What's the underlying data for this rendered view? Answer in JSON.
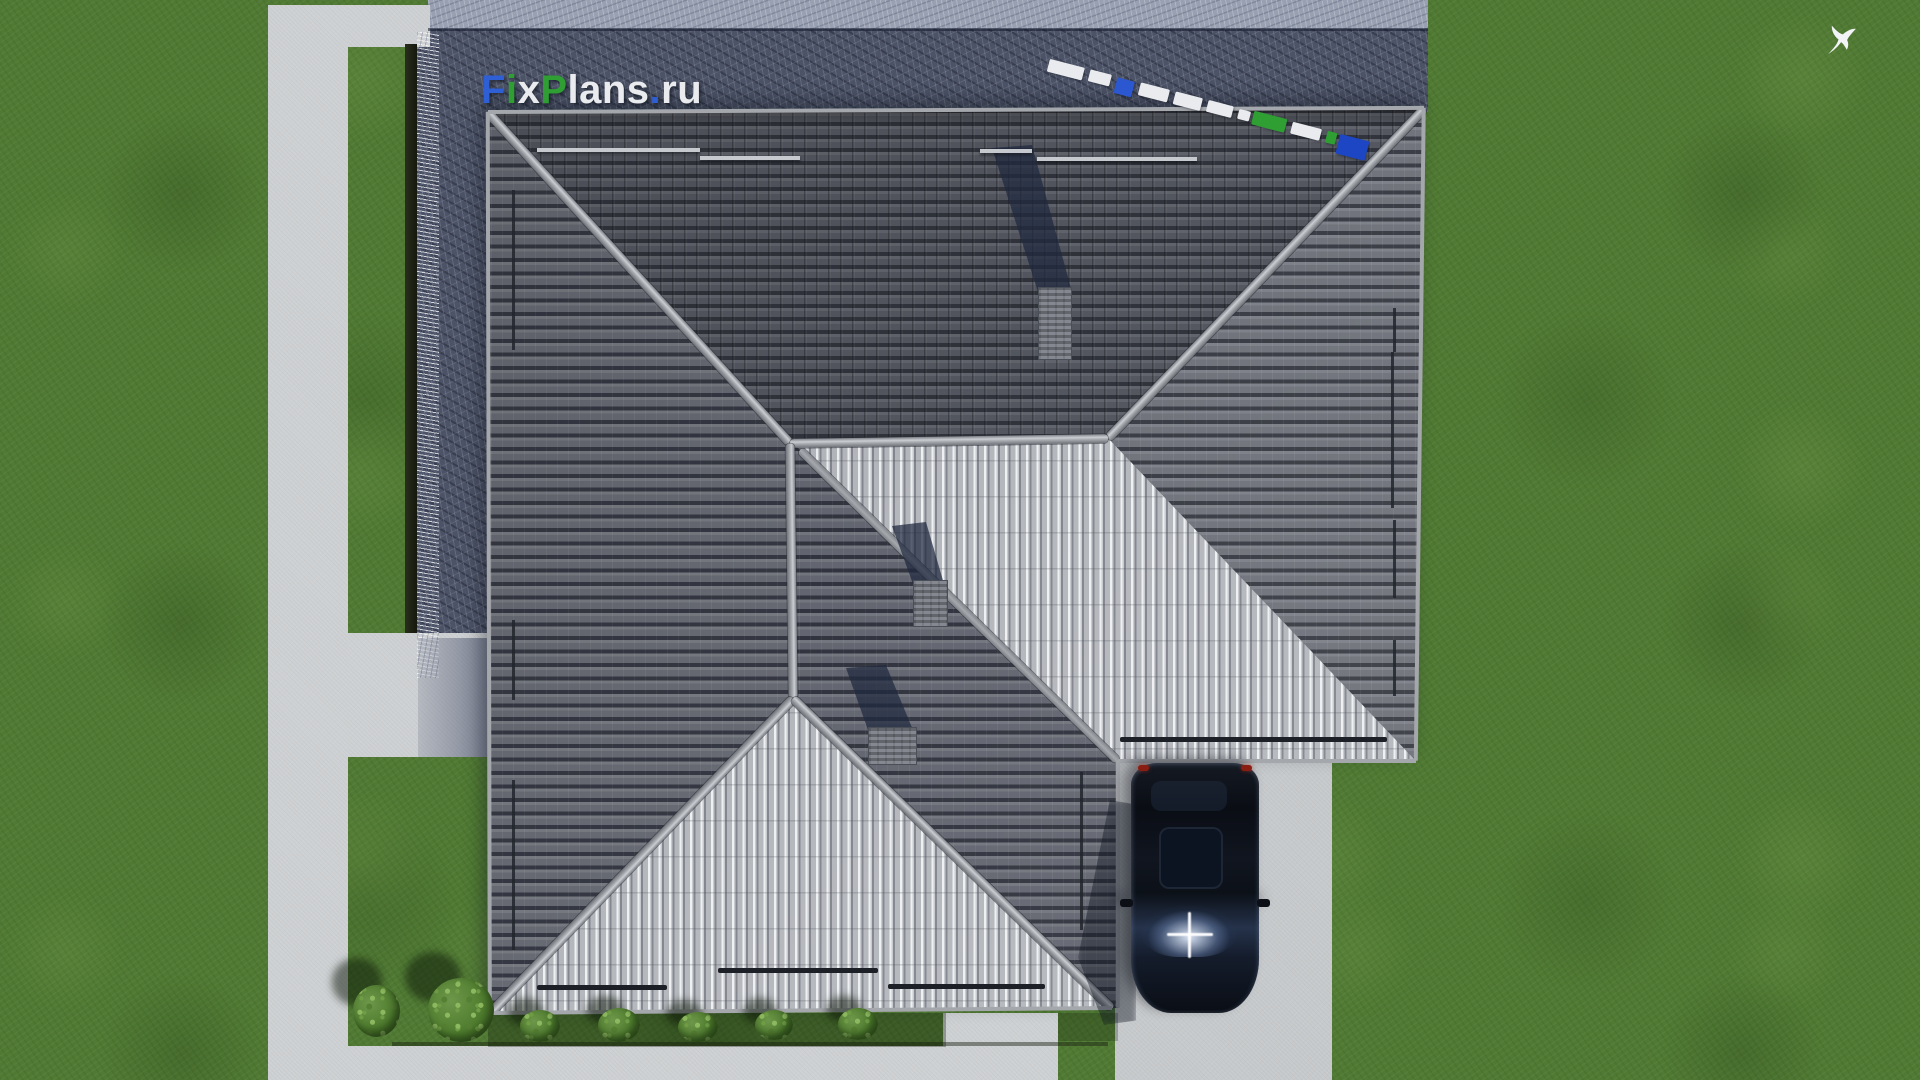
{
  "scene_title": "Top-down aerial 3D render of a hip-roof house with lawn, paths, driveway and parked car",
  "watermark": {
    "text": "FixPlans.ru",
    "parts": [
      {
        "text": "F",
        "color": "#2f5fd4"
      },
      {
        "text": "i",
        "color": "#2f9e33"
      },
      {
        "text": "x",
        "color": "#e9ebee"
      },
      {
        "text": "P",
        "color": "#2f9e33"
      },
      {
        "text": "lans",
        "color": "#e9ebee"
      },
      {
        "text": ".",
        "color": "#2f5fd4"
      },
      {
        "text": "ru",
        "color": "#e9ebee"
      }
    ]
  },
  "logo_dashes": {
    "segments": [
      {
        "w": 36,
        "h": 13,
        "c": "#e9ebee"
      },
      {
        "w": 22,
        "h": 12,
        "c": "#e9ebee"
      },
      {
        "w": 18,
        "h": 16,
        "c": "#2b57d0"
      },
      {
        "w": 30,
        "h": 13,
        "c": "#e9ebee"
      },
      {
        "w": 28,
        "h": 13,
        "c": "#e9ebee"
      },
      {
        "w": 26,
        "h": 12,
        "c": "#e9ebee"
      },
      {
        "w": 12,
        "h": 10,
        "c": "#e9ebee"
      },
      {
        "w": 34,
        "h": 14,
        "c": "#2f9e33"
      },
      {
        "w": 30,
        "h": 12,
        "c": "#e9ebee"
      },
      {
        "w": 10,
        "h": 12,
        "c": "#2f9e33"
      },
      {
        "w": 30,
        "h": 20,
        "c": "#1d46c4"
      }
    ]
  },
  "palette": {
    "grass": "#507a33",
    "path": "#ced1d3",
    "driveway": "#c7cacc",
    "terrace_paving": "#4c5367",
    "roof_dark": "#565962",
    "roof_medium": "#70737b",
    "roof_bright": "#d6d8db",
    "ridge_cap": "#b6b9be",
    "shadow_navy": "#263350",
    "car_body": "#0b0f16",
    "bush_green": "#4c7a2c",
    "bird_white": "#f2f4f7"
  },
  "objects": {
    "chimneys": 3,
    "bushes_large": 2,
    "bushes_small": 5,
    "cars": 1,
    "birds": 1
  }
}
